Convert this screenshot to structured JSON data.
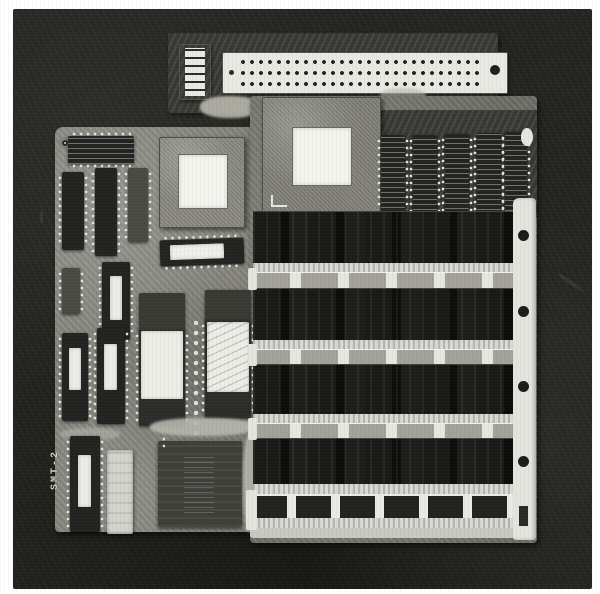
{
  "photo": {
    "description": "Black-and-white photograph of a computer main board assembly on a dark background",
    "background_color": "#23231f",
    "frame_color": "#ffffff"
  },
  "board": {
    "silkscreen": "SMT-2",
    "pcb_color": "#85857d",
    "chip_color": "#232321",
    "connector_color": "#e9e9e3",
    "simm_color": "#131311"
  },
  "top_connector": {
    "pin_rows": 3,
    "pin_columns": 28
  },
  "memory": {
    "installed_simm_rows": 4,
    "empty_socket_rows": 1
  },
  "chips": {
    "large_pga_count": 2,
    "eprom_count": 2,
    "top_right_dip_count": 5
  }
}
